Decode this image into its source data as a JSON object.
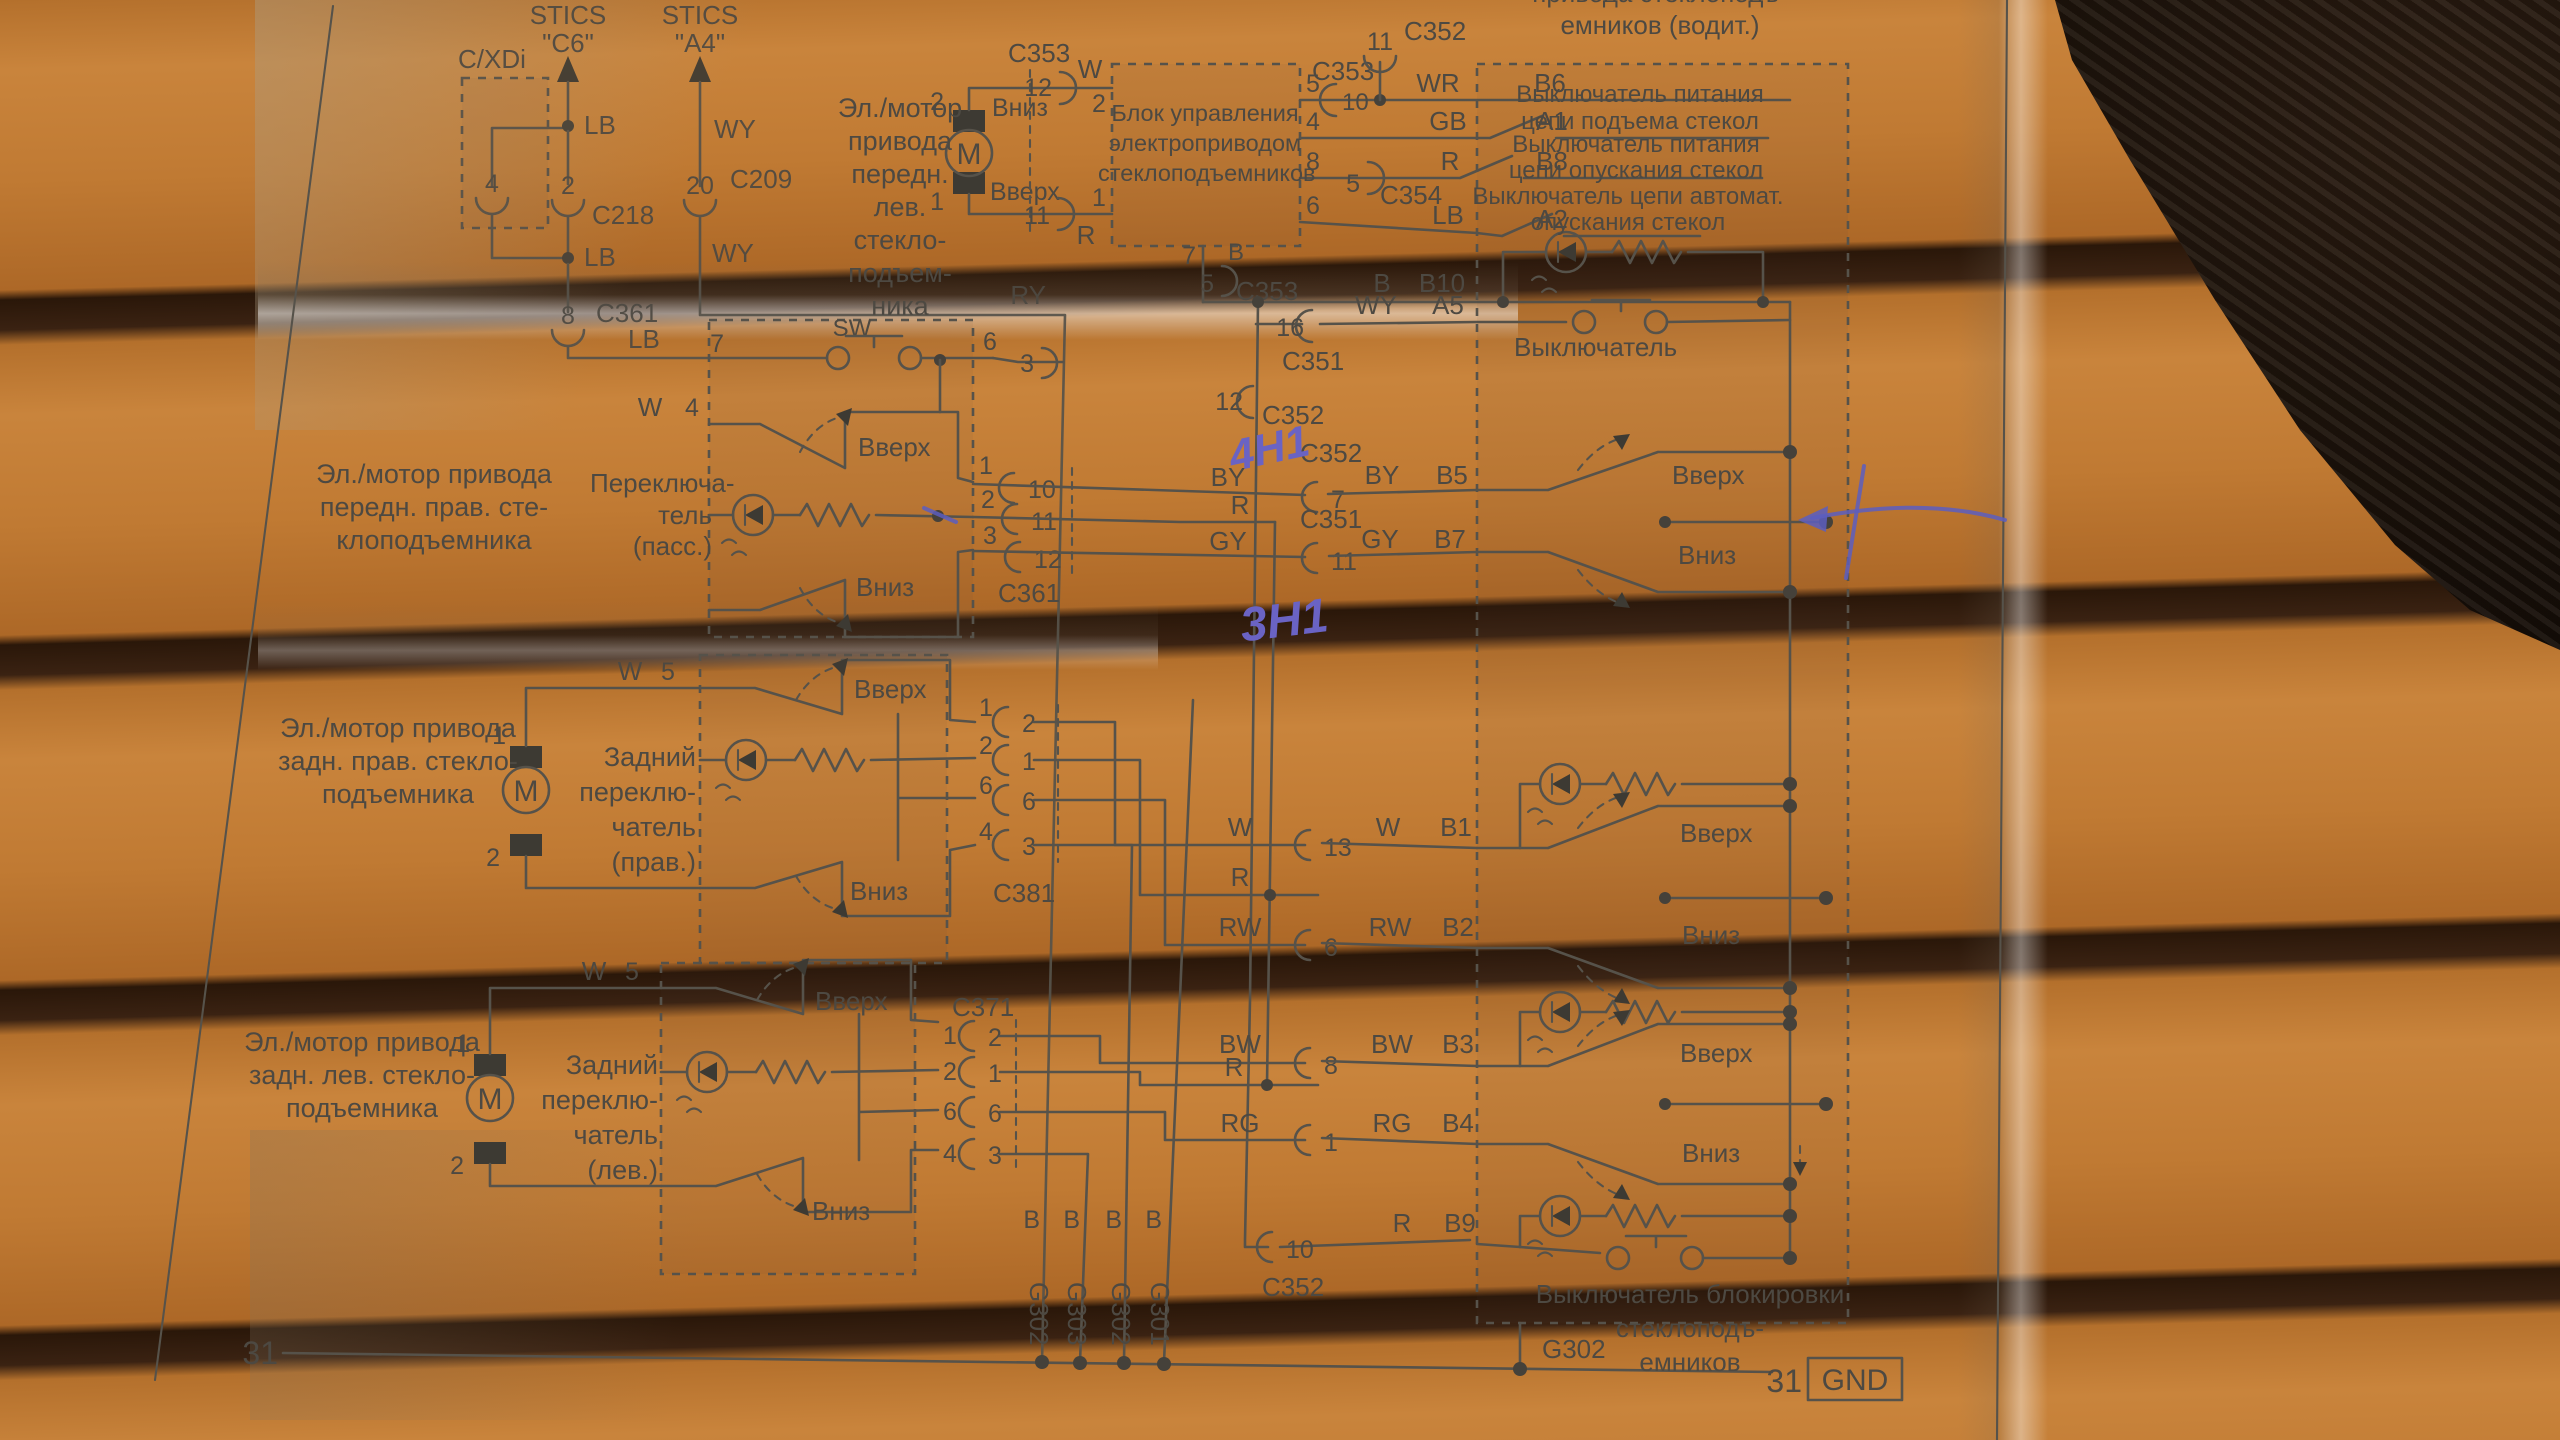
{
  "texts": {
    "stics": "STICS",
    "stics_c6": "\"C6\"",
    "stics_a4": "\"A4\"",
    "cxdi": "C/XDi",
    "sw": "SW",
    "motor_m": "M",
    "up": "Вверх",
    "down": "Вниз",
    "vykl": "Выключатель",
    "motor_front_left": "Эл./мотор\nпривода\nпередн.\nлев.\nстекло-\nподъем-\nника",
    "ctrl_unit": "Блок управления\nэлектроприводом\nстеклоподъемников",
    "panel_title": "привода стеклоподъ-\nемников (водит.)",
    "psw_up": "Выключатель питания\nцепи подъема стекол",
    "psw_down": "Выключатель питания\nцепи опускания стекол",
    "psw_auto": "Выключатель цепи автомат.\nопускания стекол",
    "motor_front_right": "Эл./мотор привода\nпередн. прав. сте-\nклоподъемника",
    "switch_pass": "Переключа-\nтель\n(пасс.)",
    "motor_rear_right": "Эл./мотор привода\nзадн. прав. стекло-\nподъемника",
    "switch_rear_right": "Задний\nпереклю-\nчатель\n(прав.)",
    "motor_rear_left": "Эл./мотор привода\nзадн. лев. стекло-\nподъемника",
    "switch_rear_left": "Задний\nпереклю-\nчатель\n(лев.)",
    "lock_switch": "Выключатель блокировки стеклоподъ-\nемников",
    "hw_4n1": "4Н1",
    "hw_3n1": "3Н1"
  },
  "wires": {
    "w": "W",
    "r": "R",
    "b": "B",
    "lb": "LB",
    "wy": "WY",
    "ry": "RY",
    "wr": "WR",
    "gb": "GB",
    "by": "BY",
    "gy": "GY",
    "rw": "RW",
    "bw": "BW",
    "rg": "RG"
  },
  "pins": {
    "p1": "1",
    "p2": "2",
    "p3": "3",
    "p4": "4",
    "p5": "5",
    "p6": "6",
    "p7": "7",
    "p8": "8",
    "p10": "10",
    "p11": "11",
    "p12": "12",
    "p13": "13",
    "p16": "16",
    "p20": "20"
  },
  "connectors": {
    "c209": "C209",
    "c218": "C218",
    "c351": "C351",
    "c352": "C352",
    "c353": "C353",
    "c354": "C354",
    "c361": "C361",
    "c371": "C371",
    "c381": "C381"
  },
  "terminals": {
    "a1": "A1",
    "a2": "A2",
    "a5": "A5",
    "b1": "B1",
    "b2": "B2",
    "b3": "B3",
    "b4": "B4",
    "b5": "B5",
    "b6": "B6",
    "b7": "B7",
    "b8": "B8",
    "b9": "B9",
    "b10": "B10"
  },
  "grounds": {
    "g301": "G301",
    "g302": "G302",
    "g303": "G303",
    "gnd": "GND",
    "n31": "31"
  }
}
